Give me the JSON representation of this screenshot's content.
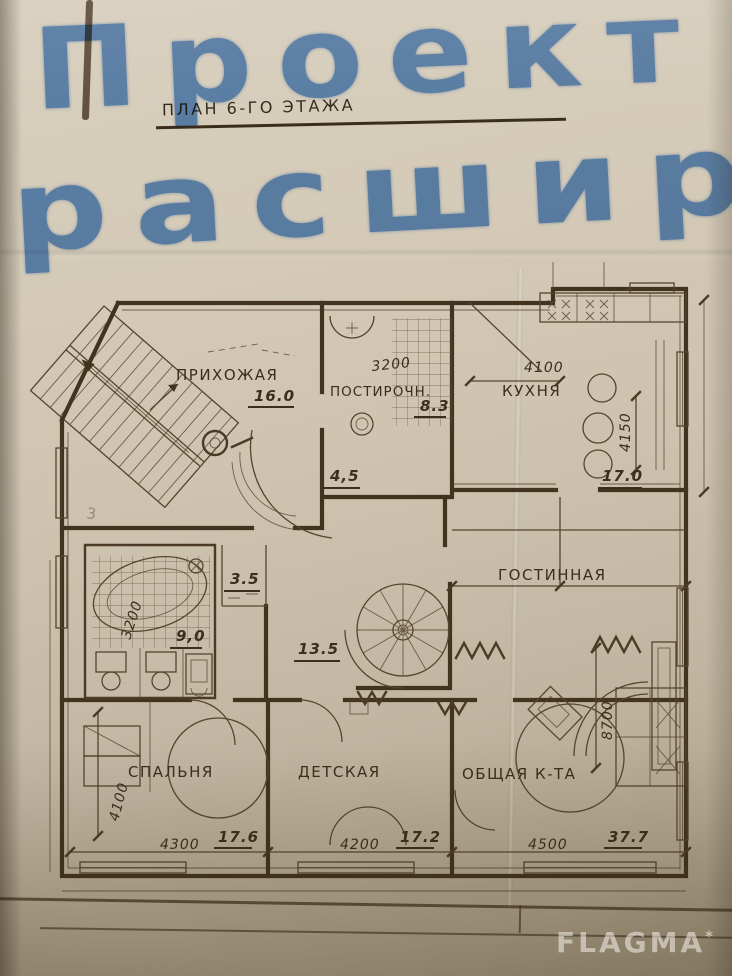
{
  "annotation": {
    "line1": "Проект",
    "line2": "расшир.",
    "marker_color": "#4d88d8"
  },
  "plan": {
    "title": "ПЛАН 6-ГО ЭТАЖА",
    "ink_color": "#42331e",
    "rooms": {
      "hallway": {
        "name": "ПРИХОЖАЯ",
        "area": "16.0"
      },
      "laundry": {
        "name": "ПОСТИРОЧН.",
        "area": "8.3",
        "width_mm": "3200"
      },
      "kitchen": {
        "name": "КУХНЯ",
        "area": "17.0",
        "width_mm": "4100",
        "depth_mm": "4150"
      },
      "entry_lobby": {
        "area": "4,5"
      },
      "living": {
        "name": "ГОСТИННАЯ",
        "depth_mm": "8700"
      },
      "bathroom": {
        "area": "9,0",
        "width_mm": "3200"
      },
      "wc": {
        "area": "3.5"
      },
      "corridor": {
        "area": "13.5"
      },
      "bedroom": {
        "name": "СПАЛЬНЯ",
        "area": "17.6",
        "width_mm": "4300",
        "depth_mm": "4100"
      },
      "children": {
        "name": "ДЕТСКАЯ",
        "area": "17.2",
        "width_mm": "4200"
      },
      "common_room": {
        "name": "ОБЩАЯ К-ТА",
        "area": "37.7",
        "width_mm": "4500"
      }
    },
    "pencil_mark": "3"
  },
  "watermark": {
    "text": "FLAGMA",
    "star": "*"
  }
}
